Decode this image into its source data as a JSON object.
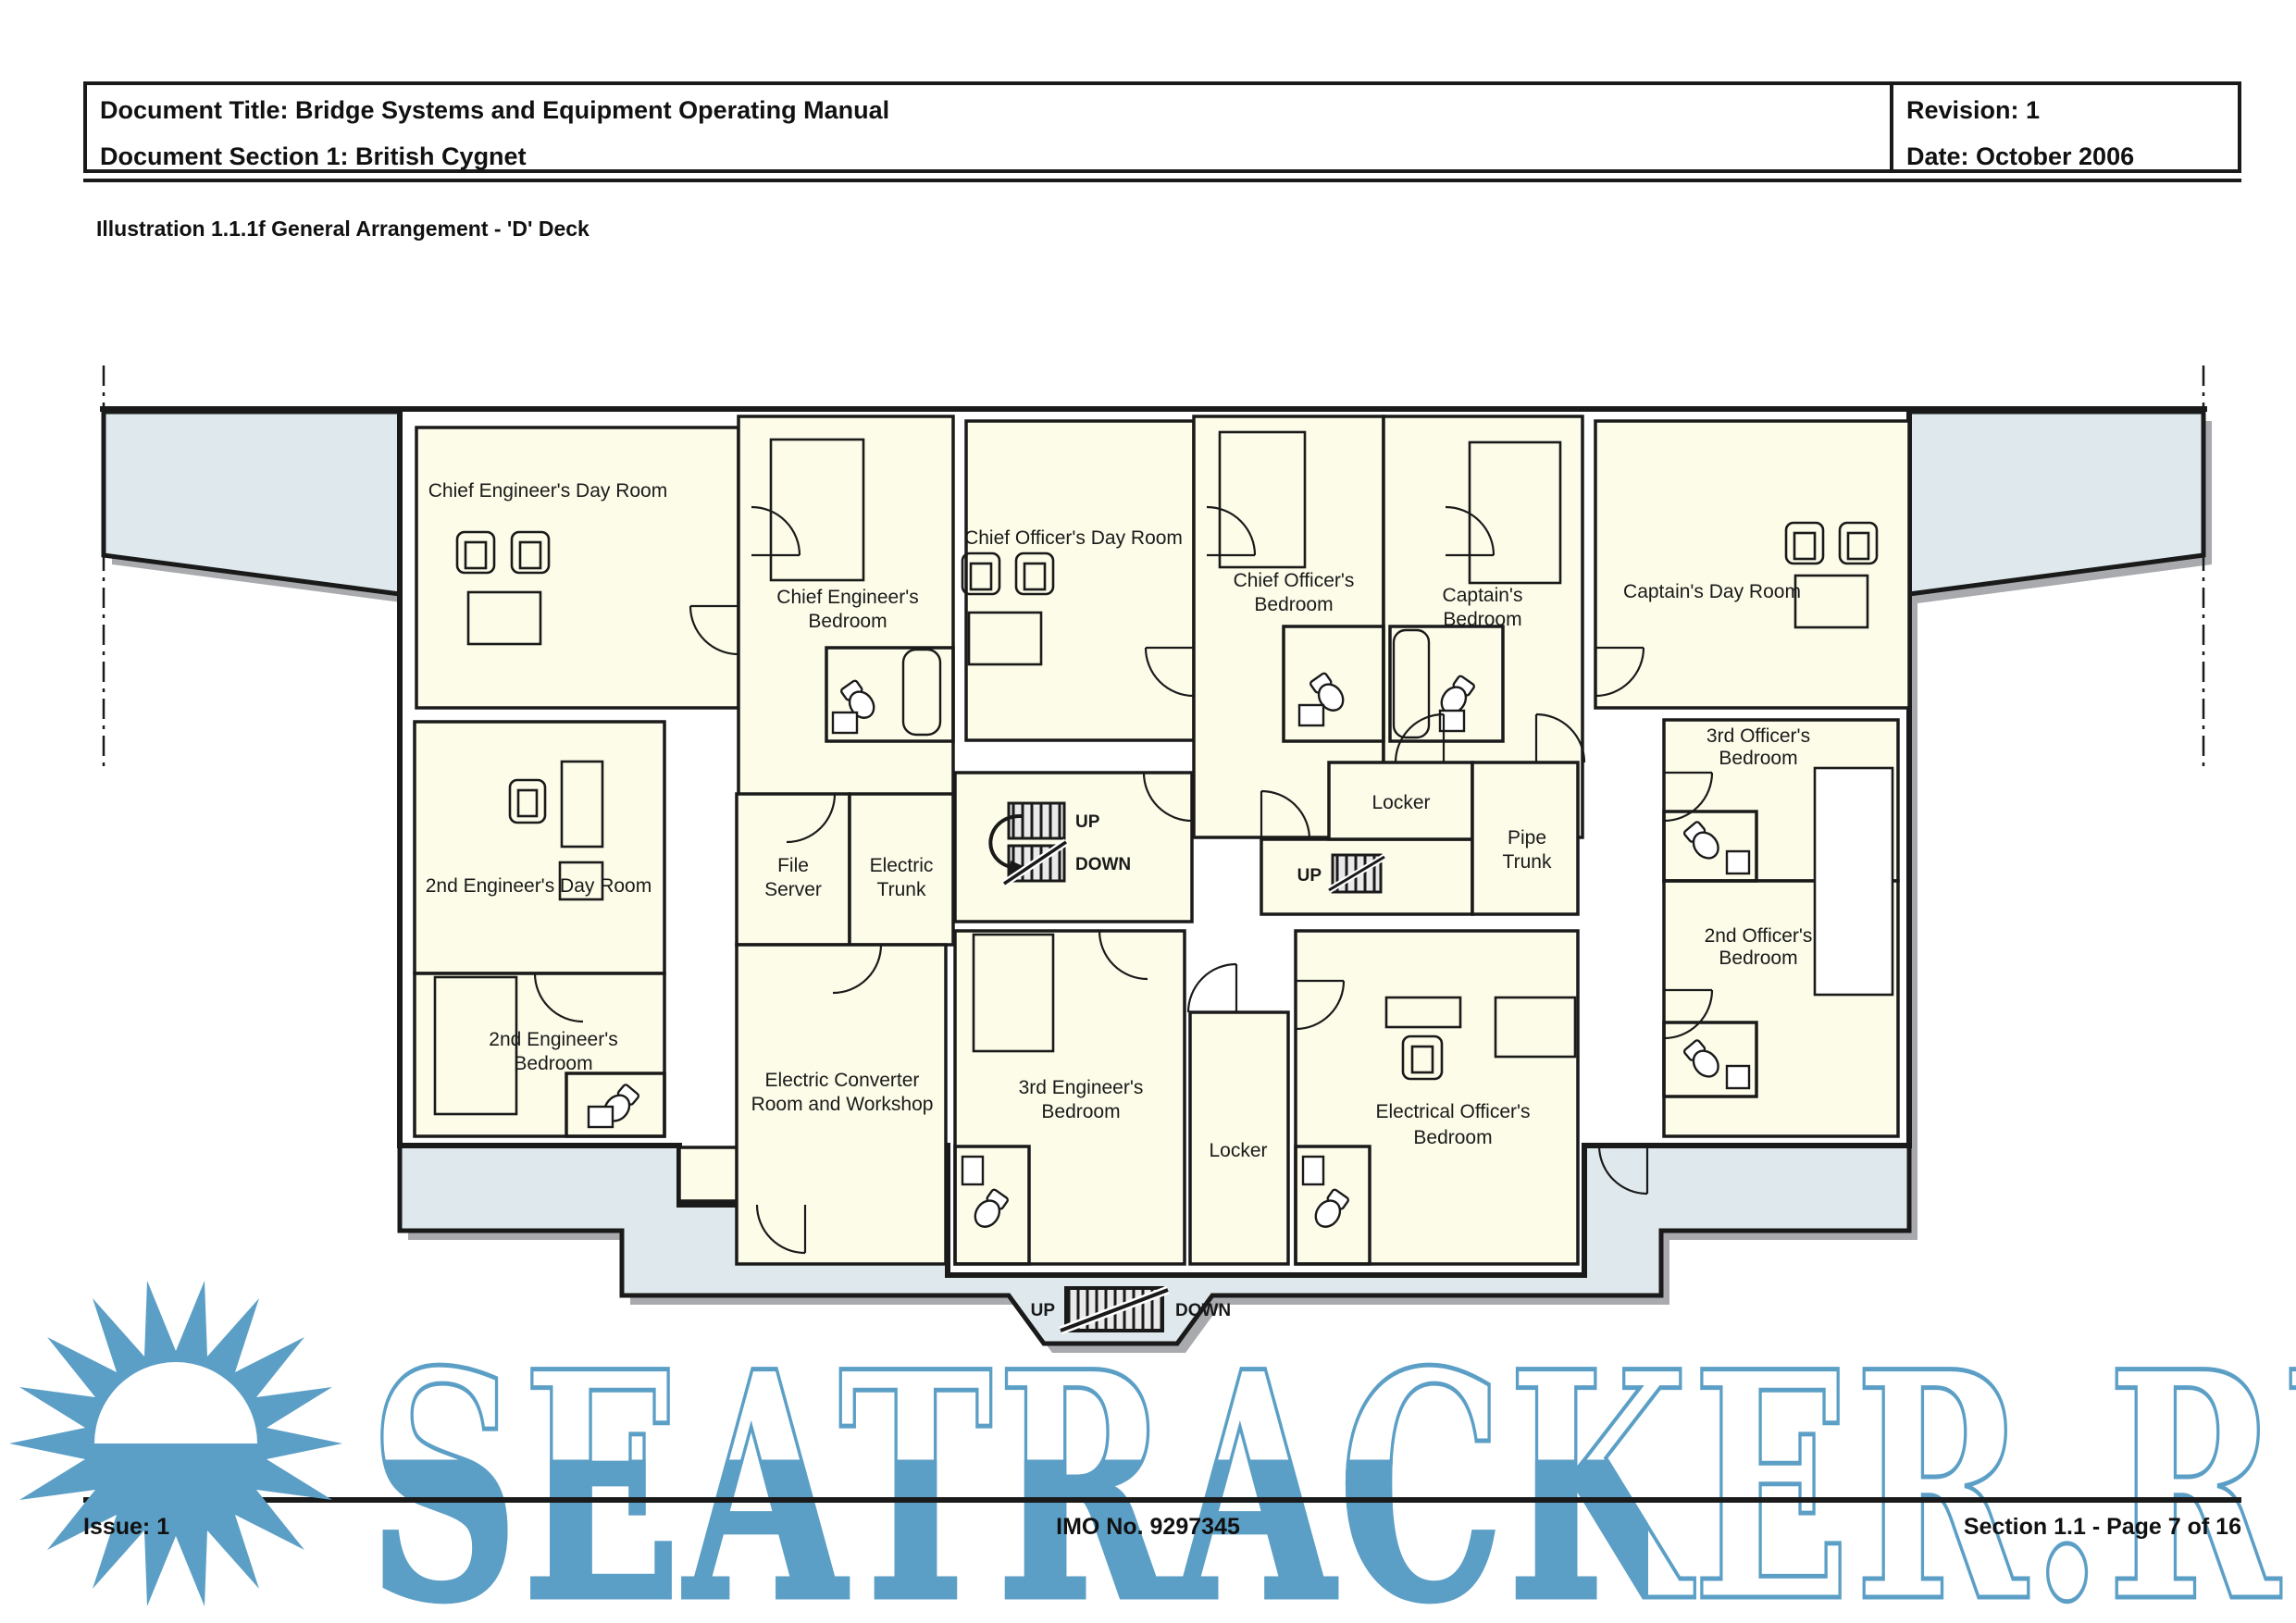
{
  "header": {
    "document_title": "Document Title: Bridge Systems and Equipment Operating Manual",
    "document_section": "Document Section 1: British Cygnet",
    "revision": "Revision: 1",
    "date": "Date: October 2006"
  },
  "illustration_title": "Illustration 1.1.1f General Arrangement - 'D' Deck",
  "plan": {
    "rooms": {
      "chief_engineers_day_room": "Chief Engineer's Day Room",
      "chief_engineers_bedroom": [
        "Chief Engineer's",
        "Bedroom"
      ],
      "chief_officers_day_room": "Chief Officer's Day Room",
      "chief_officers_bedroom": [
        "Chief Officer's",
        "Bedroom"
      ],
      "captains_bedroom": [
        "Captain's",
        "Bedroom"
      ],
      "captains_day_room": "Captain's Day Room",
      "second_engineers_day_room": "2nd Engineer's Day Room",
      "second_engineers_bedroom": [
        "2nd Engineer's",
        "Bedroom"
      ],
      "file_server": [
        "File",
        "Server"
      ],
      "electric_trunk": [
        "Electric",
        "Trunk"
      ],
      "electric_converter_room": [
        "Electric Converter",
        "Room and Workshop"
      ],
      "third_engineers_bedroom": [
        "3rd Engineer's",
        "Bedroom"
      ],
      "locker_bottom": "Locker",
      "locker_top": "Locker",
      "pipe_trunk": [
        "Pipe",
        "Trunk"
      ],
      "electrical_officers_bedroom": [
        "Electrical Officer's",
        "Bedroom"
      ],
      "third_officers_bedroom": [
        "3rd Officer's",
        "Bedroom"
      ],
      "second_officers_bedroom": [
        "2nd Officer's",
        "Bedroom"
      ]
    },
    "stairs": {
      "up": "UP",
      "down": "DOWN"
    }
  },
  "footer": {
    "issue": "Issue: 1",
    "imo": "IMO No. 9297345",
    "section_page": "Section 1.1  -  Page 7 of 16"
  },
  "watermark": {
    "text": "SEATRACKER.RU",
    "color": "#5c9fc6"
  },
  "colors": {
    "room_fill": "#fdfce9",
    "deck_fill": "#dfe9ed",
    "wall": "#1a1a1a",
    "shadow": "#a9aaae",
    "watermark_blue": "#5c9fc6"
  }
}
